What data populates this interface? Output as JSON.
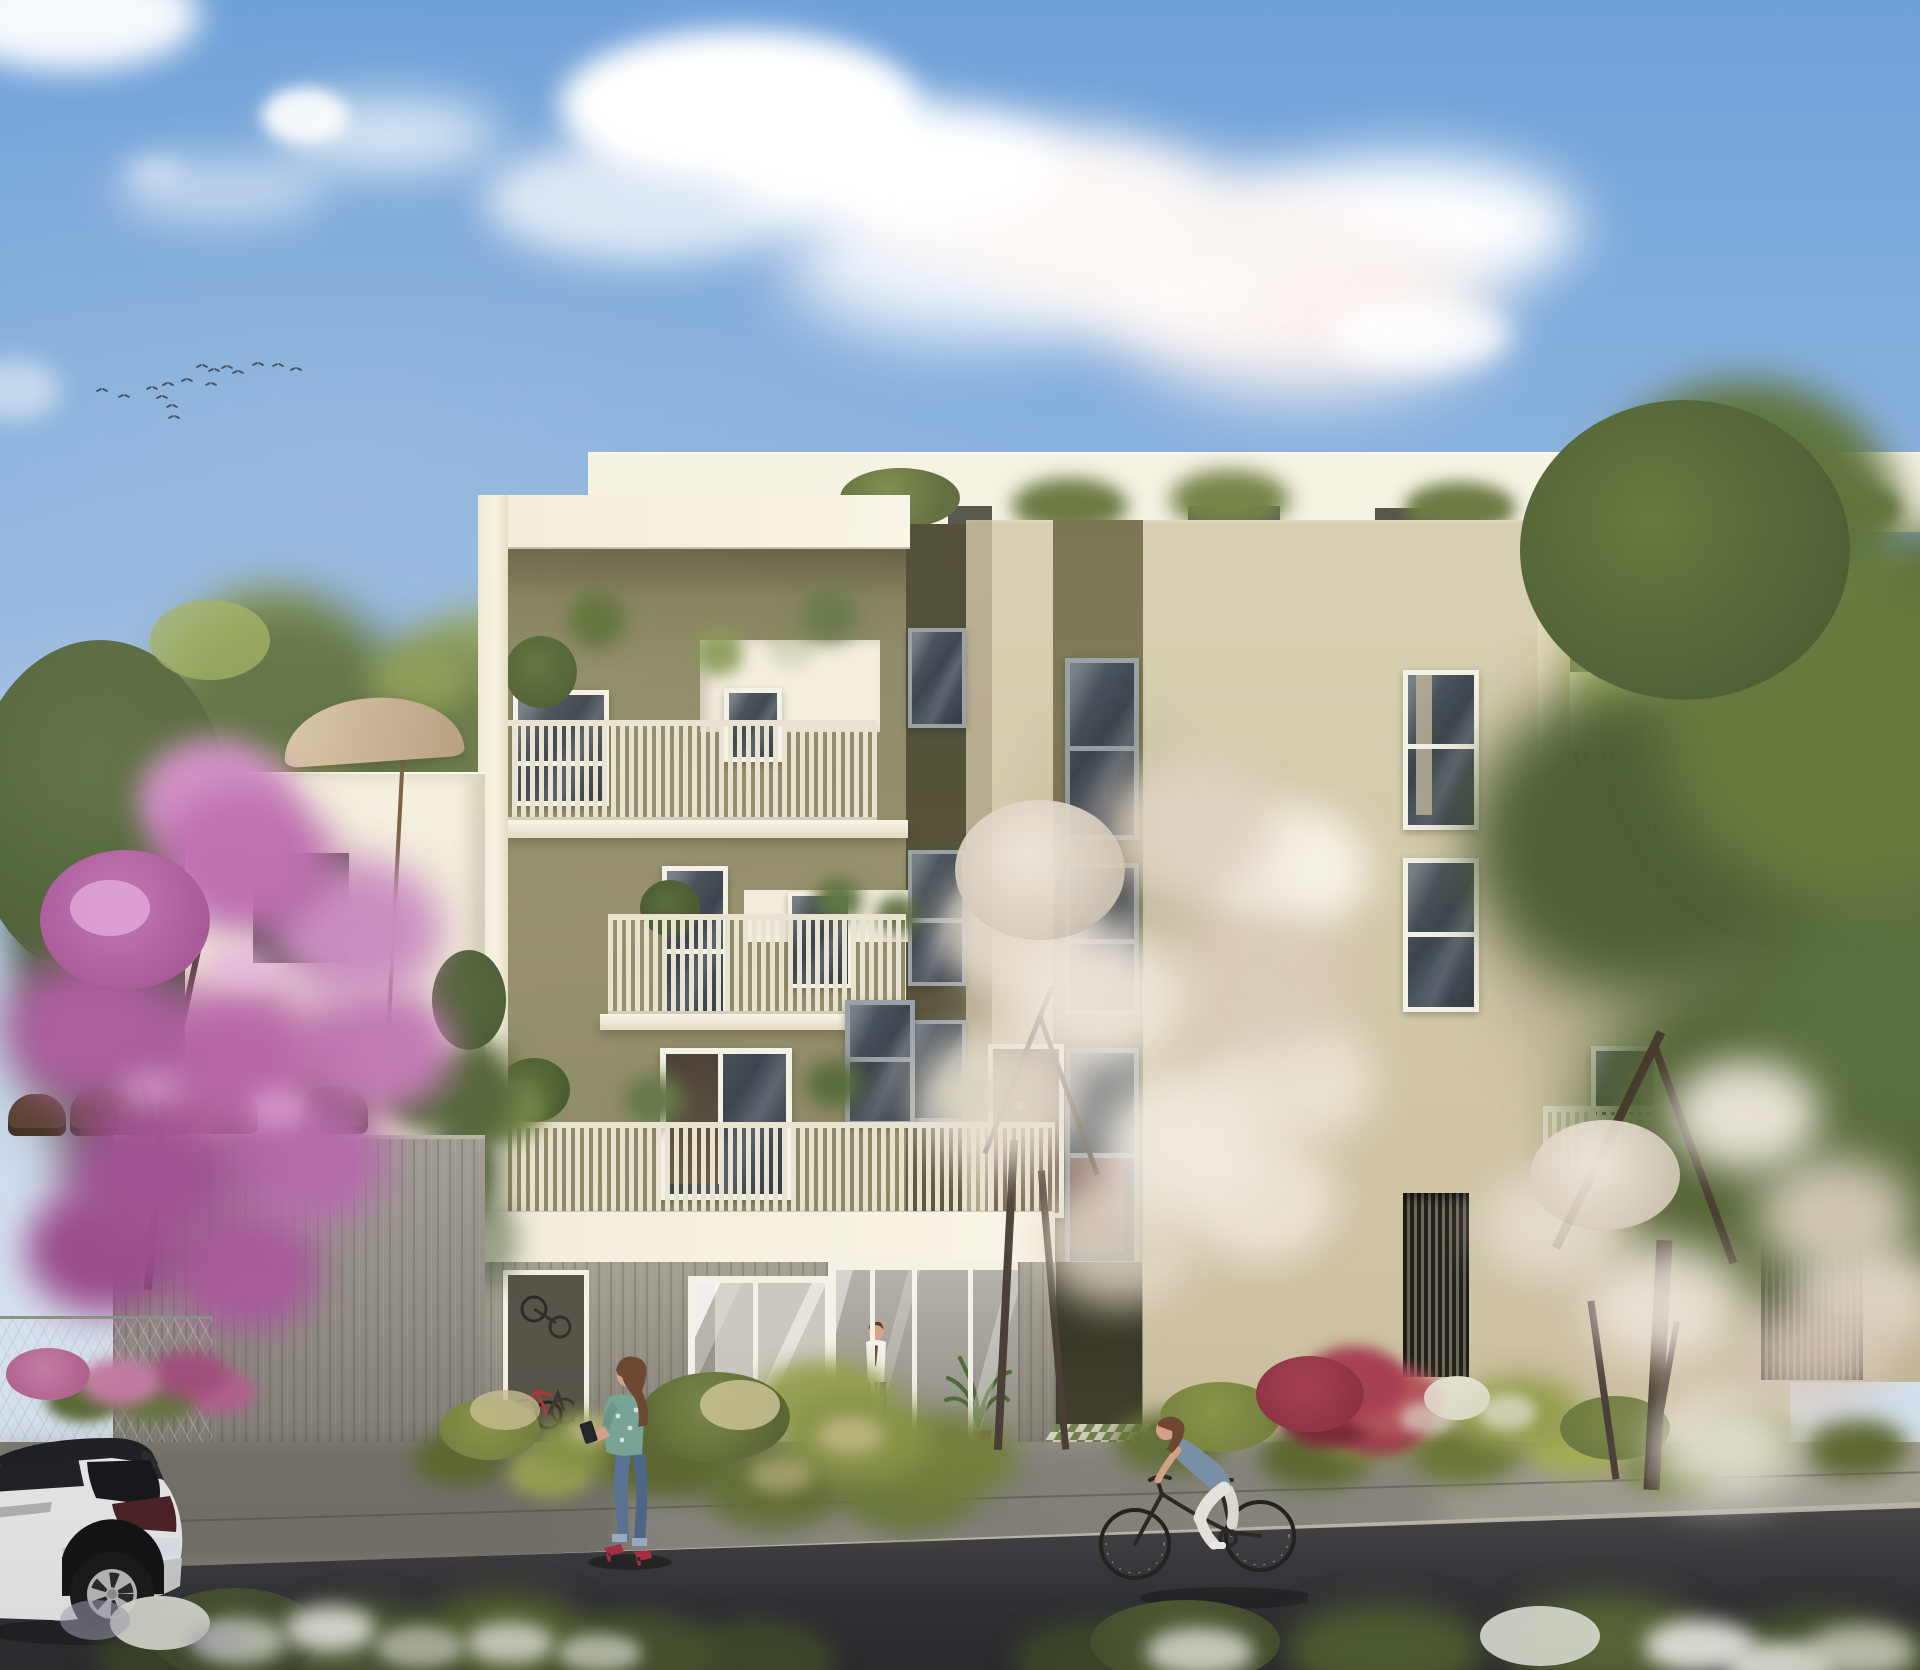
{
  "scene": {
    "description": "Sunny architectural rendering of a modern four-storey residential building with cream and olive-green facades, slatted balcony railings with plants, a glass entrance lobby, flowering trees, a parked white SUV, a woman looking at her phone and a woman cycling on the street",
    "time_of_day": "day",
    "storeys": 4,
    "colors": {
      "sky_top": "#6FA0D8",
      "sky_mid": "#92B7E0",
      "sky_low": "#BDD1E9",
      "sky_horizon": "#D3E0EE",
      "cloud": "#FFFFFF",
      "attic": "#F6F2E4",
      "cream": "#F2ECDA",
      "cream_bright": "#F9F5E8",
      "cream_shade": "#E2DAC4",
      "olive": "#8E8A67",
      "olive_deep": "#76724F",
      "olive_shadow": "#5C593F",
      "beige": "#D6CCAE",
      "beige_light": "#DCD3B7",
      "beige_shadow": "#B9AE8F",
      "gap_dark": "#55523A",
      "frame_white": "#F4F1E6",
      "window_gray": "#9AA1A7",
      "glass": "#3E474F",
      "glass_light": "#5B656E",
      "railing": "#E9E3D1",
      "railing_base": "#D8D1BB",
      "wood": "#9A968A",
      "wood_dark": "#726E63",
      "recess_dark": "#3F3D2C",
      "curtain": "#8D6B5F",
      "interior_warm": "#75654E",
      "lamp_orange": "#D98B4A",
      "sidewalk": "#98958C",
      "sidewalk_light": "#A8A49A",
      "curb": "#B6B2A6",
      "road": "#38383B",
      "road_light": "#4A4A4D",
      "green_dark": "#49572F",
      "green": "#5F7038",
      "green_light": "#7E8F4A",
      "green_sun": "#A9B85F",
      "grass_dry": "#C9C193",
      "blossom_pink": "#BD6FB0",
      "blossom_pink_light": "#DC9FD0",
      "blossom_white": "#E9E2D5",
      "blossom_white_shade": "#D5C8B9",
      "flower_red": "#A23A4C",
      "flower_pink": "#C58CA8",
      "umbrella": "#CDBA9B",
      "fence_wood": "#97938A",
      "tile_green": "#7C8E58",
      "tile_white": "#E7E3D3",
      "car_white": "#E9EAEA",
      "car_dark": "#1F2124",
      "car_glass": "#17181B",
      "skin": "#D7A488",
      "hair_brown": "#6F4832",
      "denim": "#7B93AA",
      "jeans": "#5A7697",
      "teal_top": "#7AA79A",
      "shoe_red": "#AB2F3F",
      "shirt_white": "#F2F1EC",
      "pants_dark": "#3C4450",
      "bird": "#263040",
      "person_blue": "#4F7D8A"
    },
    "birds": [
      [
        196,
        363
      ],
      [
        208,
        367
      ],
      [
        221,
        364
      ],
      [
        232,
        369
      ],
      [
        252,
        361
      ],
      [
        272,
        362
      ],
      [
        290,
        366
      ],
      [
        181,
        377
      ],
      [
        162,
        381
      ],
      [
        146,
        385
      ],
      [
        118,
        393
      ],
      [
        96,
        387
      ],
      [
        156,
        394
      ],
      [
        166,
        403
      ],
      [
        205,
        381
      ],
      [
        168,
        414
      ]
    ],
    "objects": {
      "sky": "blue sky with clouds",
      "birds": "flock of birds",
      "building": "modern four-storey residential building with balconies",
      "left_block": "cream frame block with olive facade and slatted balconies",
      "right_block": "beige block with recessed balcony",
      "annex": "low annex building with rooftop terrace",
      "umbrella": "beige patio umbrella",
      "terrace_chairs": "terrace chairs and table",
      "wood_fence": "wooden plank fence",
      "pink_tree": "pink flowering tree",
      "white_tree_center": "white blossom tree",
      "white_tree_right": "white blossom tree",
      "big_tree_right": "large green tree",
      "bike_room": "bicycle storage room with bikes",
      "entrance": "glass entrance lobby",
      "lobby_man": "man walking inside the entrance lobby",
      "phone_woman": "woman standing on the sidewalk looking at her phone",
      "cyclist": "woman riding a bicycle",
      "car": "white SUV with black roof parked on the street",
      "balcony_people": "residents on a balcony with pink flowers",
      "planting": "ornamental grasses and shrubs",
      "hedge": "flowering hedge along the street",
      "road": "asphalt street",
      "sidewalk": "concrete sidewalk"
    }
  }
}
